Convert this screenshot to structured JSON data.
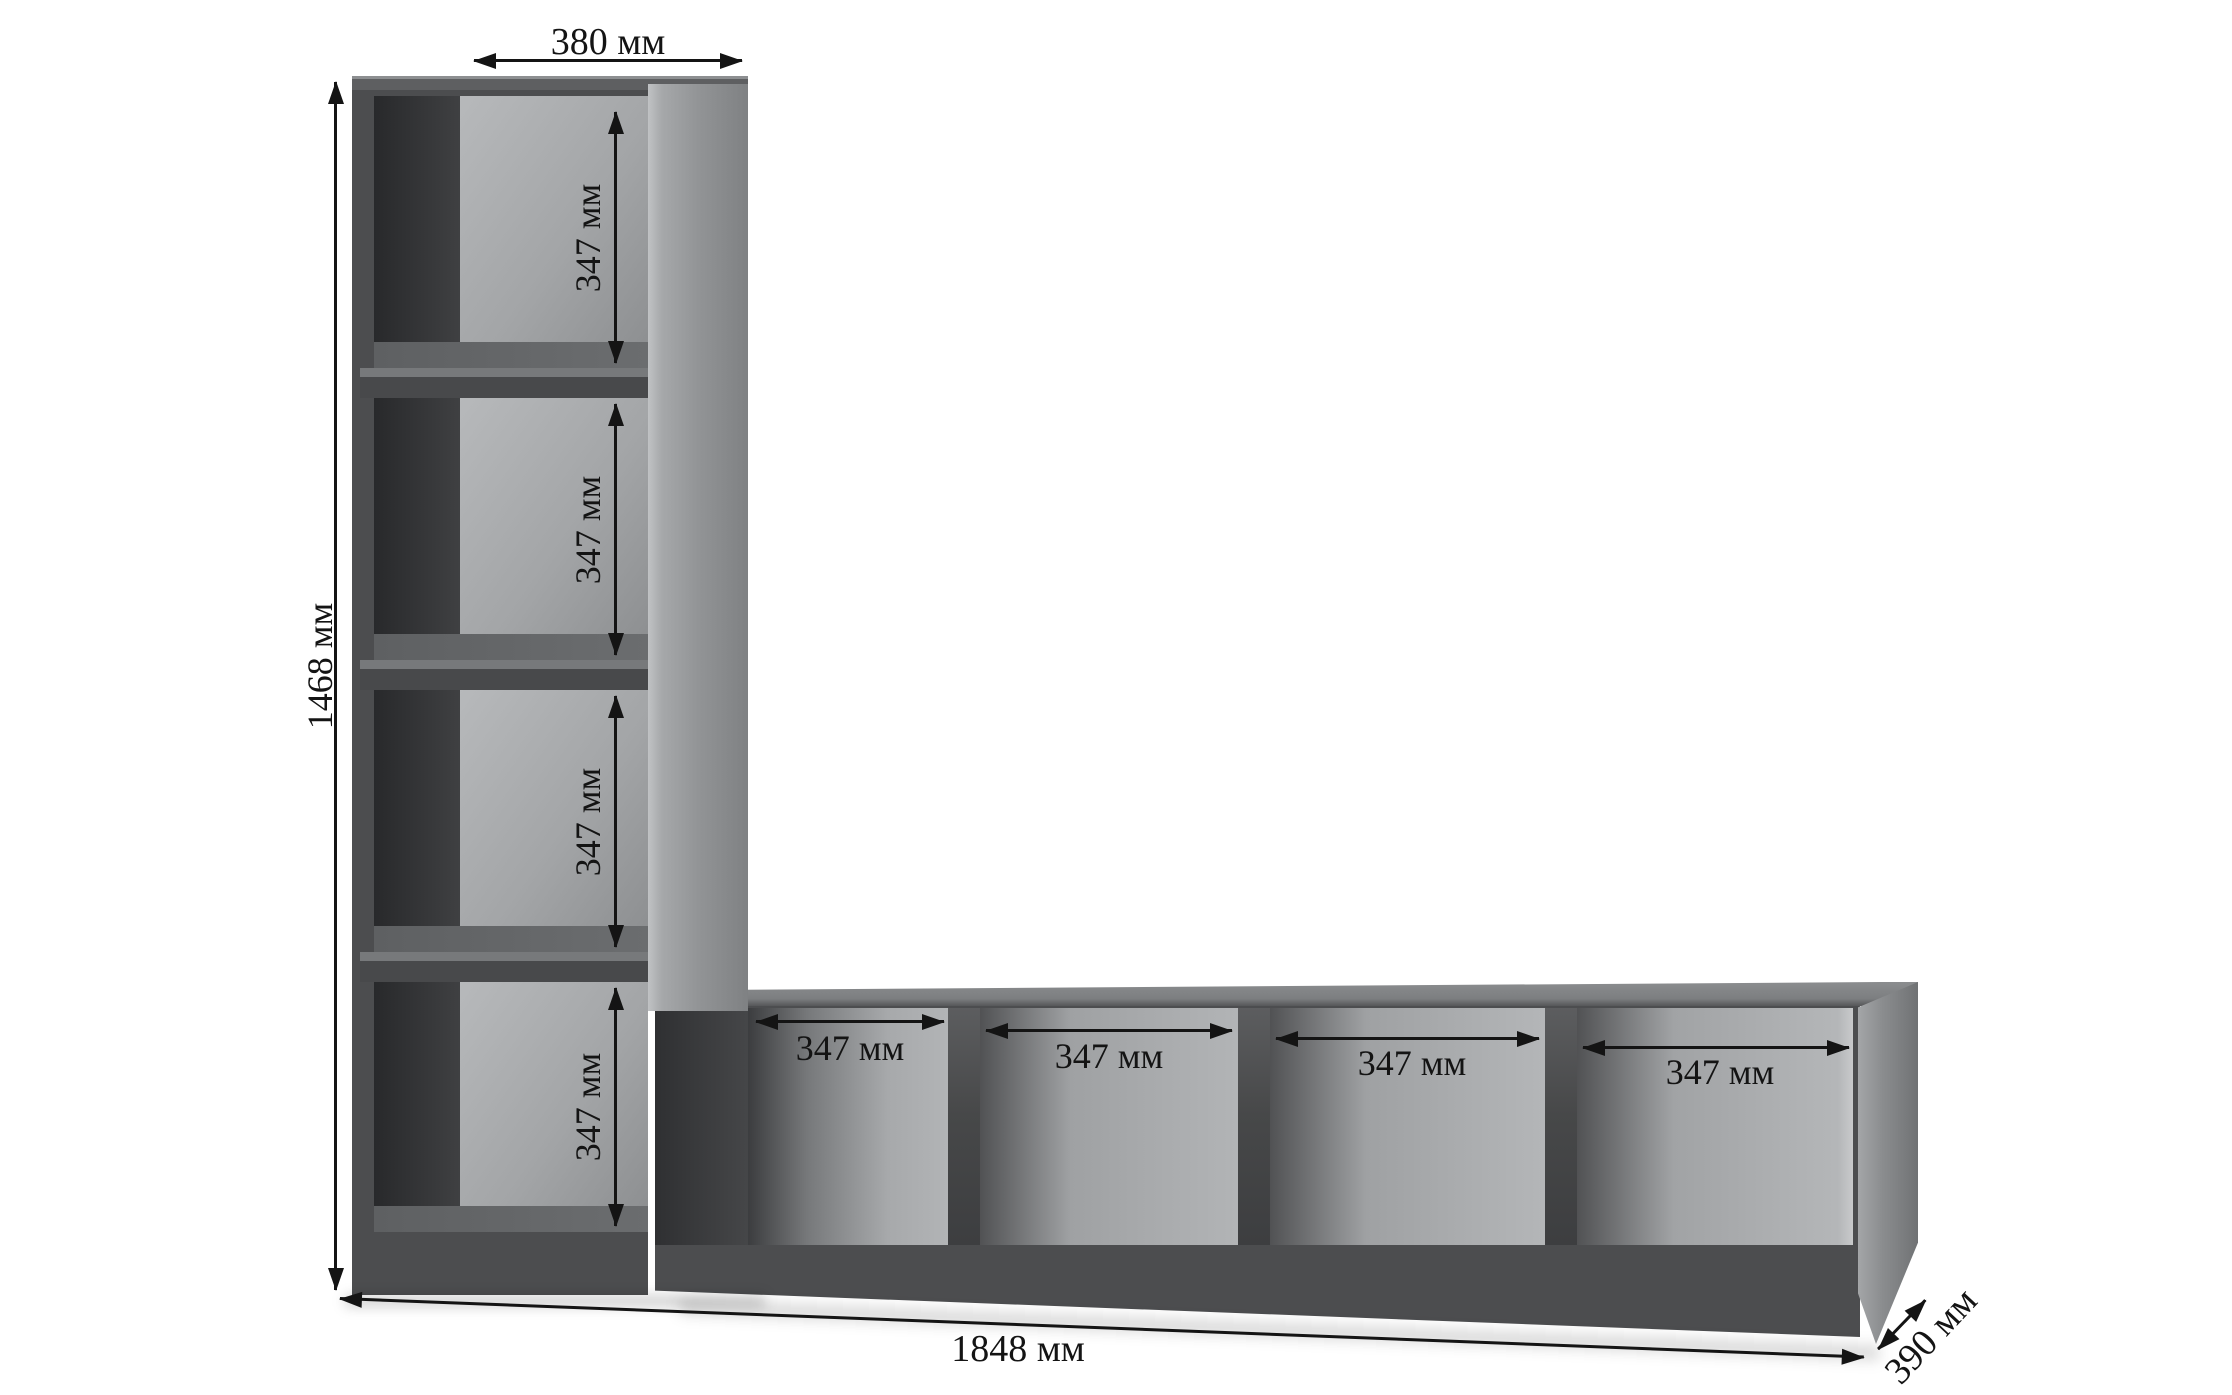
{
  "page": {
    "background": "#ffffff",
    "description": "Dimension diagram of an L-shaped cube shelving unit"
  },
  "unit": {
    "colors": {
      "front_face": "#4c4d4f",
      "top_face": "#5e5f61",
      "side_panel": "#97999b",
      "interior_back": "#b2b4b6",
      "interior_shadow": "#3a3b3d",
      "shelf_floor": "#67696b",
      "dimension_text": "#141414"
    },
    "column": {
      "cells": [
        {
          "label": "347 мм"
        },
        {
          "label": "347 мм"
        },
        {
          "label": "347 мм"
        },
        {
          "label": "347 мм"
        }
      ]
    },
    "row": {
      "cells": [
        {
          "label": "347 мм"
        },
        {
          "label": "347 мм"
        },
        {
          "label": "347 мм"
        },
        {
          "label": "347 мм"
        }
      ]
    }
  },
  "dimensions": {
    "top_width": "380 мм",
    "total_height": "1468 мм",
    "total_length": "1848 мм",
    "depth": "390 мм"
  }
}
